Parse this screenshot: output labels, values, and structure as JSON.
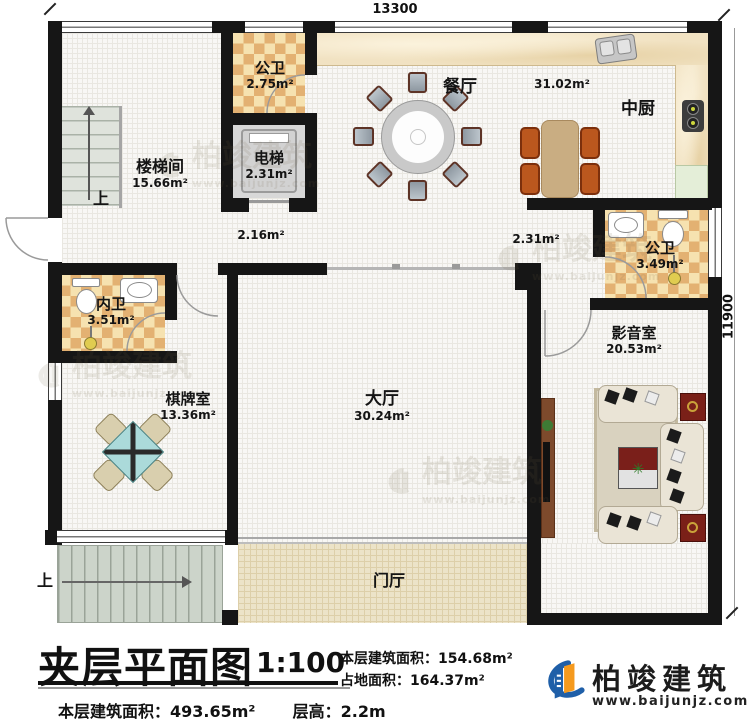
{
  "dimensions": {
    "width": "13300",
    "height": "11900"
  },
  "rooms": {
    "gongwei_top": {
      "name": "公卫",
      "area": "2.75m²"
    },
    "loutijian": {
      "name": "楼梯间",
      "area": "15.66m²"
    },
    "dianti": {
      "name": "电梯",
      "area": "2.31m²"
    },
    "canting": {
      "name": "餐厅",
      "area": "31.02m²"
    },
    "zhongchu": {
      "name": "中厨"
    },
    "gongwei_right": {
      "name": "公卫",
      "area": "3.49m²"
    },
    "neiwei": {
      "name": "内卫",
      "area": "3.51m²"
    },
    "yingyinshi": {
      "name": "影音室",
      "area": "20.53m²"
    },
    "qipaishi": {
      "name": "棋牌室",
      "area": "13.36m²"
    },
    "dating": {
      "name": "大厅",
      "area": "30.24m²"
    },
    "menting": {
      "name": "门厅"
    },
    "corridor_left": {
      "area": "2.16m²"
    },
    "corridor_right": {
      "area": "2.31m²"
    }
  },
  "stairs": {
    "up_top": "上",
    "up_bottom": "上"
  },
  "title_block": {
    "title": "夹层平面图",
    "scale": "1:100",
    "floor_area_label": "本层建筑面积：",
    "floor_area_value": "154.68m²",
    "land_area_label": "占地面积：",
    "land_area_value": "164.37m²",
    "level_area_label": "本层建筑面积：",
    "level_area_value": "493.65m²",
    "floor_height_label": "层高：",
    "floor_height_value": "2.2m"
  },
  "logo": {
    "company": "柏竣建筑",
    "website": "www.baijunjz.com"
  },
  "watermark": {
    "company": "柏竣建筑",
    "website": "www.baijunjz.com"
  },
  "colors": {
    "wall": "#161616",
    "checker": "#e3b172",
    "logo_blue": "#1f5fa8",
    "logo_orange": "#f59a1e"
  }
}
